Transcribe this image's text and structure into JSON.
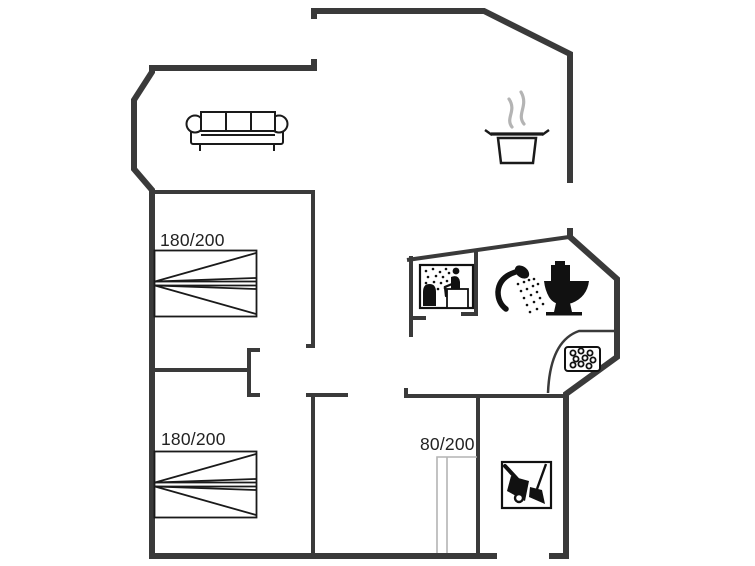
{
  "floor_plan": {
    "labels": {
      "bed_double_1": "180/200",
      "bed_double_2": "180/200",
      "bed_single": "80/200"
    },
    "icons": [
      "sofa-icon",
      "cooking-pot-icon",
      "steam-icon",
      "double-bed-icon",
      "sauna-icon",
      "shower-icon",
      "toilet-icon",
      "shower-drain-icon",
      "single-bed-icon",
      "cleaning-utility-icon"
    ],
    "colors": {
      "background": "#ffffff",
      "wall": "#3a3a3a",
      "furniture_line": "#1a1a1a",
      "icon_fill": "#111111",
      "muted_line": "#b4b4b4",
      "text": "#222222"
    }
  }
}
